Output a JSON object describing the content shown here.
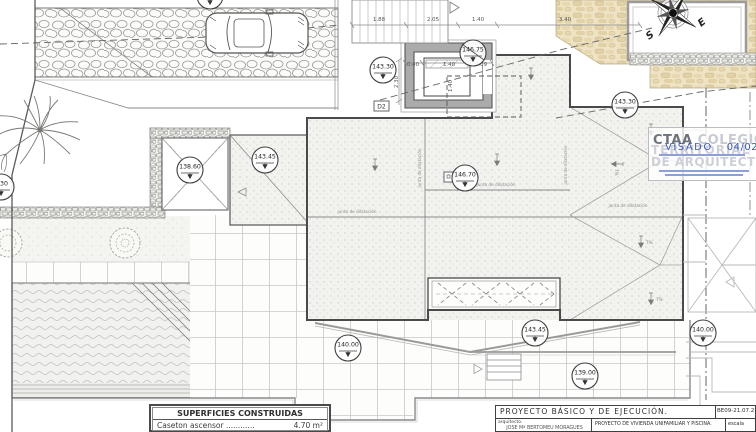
{
  "plan": {
    "markers": [
      {
        "value": "143.30",
        "x": 210,
        "y": -4
      },
      {
        "value": "143.30",
        "x": 383,
        "y": 70
      },
      {
        "value": "146.75",
        "x": 473,
        "y": 53,
        "strike": true
      },
      {
        "value": "143.30",
        "x": 625,
        "y": 105
      },
      {
        "value": "3.30",
        "x": 1,
        "y": 187
      },
      {
        "value": "138.60",
        "x": 190,
        "y": 170
      },
      {
        "value": "143.45",
        "x": 265,
        "y": 160
      },
      {
        "value": "146.70",
        "x": 465,
        "y": 178
      },
      {
        "value": "140.00",
        "x": 348,
        "y": 348
      },
      {
        "value": "143.45",
        "x": 535,
        "y": 333
      },
      {
        "value": "139.00",
        "x": 585,
        "y": 376
      },
      {
        "value": "140.00",
        "x": 703,
        "y": 333
      }
    ],
    "dimensions": [
      {
        "value": "1.88",
        "x": 379,
        "y": 21,
        "rot": 0
      },
      {
        "value": "2.05",
        "x": 433,
        "y": 21,
        "rot": 0
      },
      {
        "value": "1.40",
        "x": 478,
        "y": 21,
        "rot": 0
      },
      {
        "value": "3.40",
        "x": 565,
        "y": 21,
        "rot": 0
      },
      {
        "value": "0.40",
        "x": 413,
        "y": 66,
        "rot": 0
      },
      {
        "value": "1.40",
        "x": 449,
        "y": 66,
        "rot": 0
      },
      {
        "value": "0.09",
        "x": 481,
        "y": 66,
        "rot": 0
      },
      {
        "value": "2.30",
        "x": 398,
        "y": 82,
        "rot": -90
      },
      {
        "value": "1.40",
        "x": 452,
        "y": 86,
        "rot": -90
      }
    ],
    "slope_arrows": [
      {
        "x": 375,
        "y": 165,
        "rot": 0,
        "label": ""
      },
      {
        "x": 497,
        "y": 160,
        "rot": 0,
        "label": ""
      },
      {
        "x": 531,
        "y": 74,
        "rot": 0,
        "label": ""
      },
      {
        "x": 651,
        "y": 130,
        "rot": 0,
        "label": "7%"
      },
      {
        "x": 617,
        "y": 164,
        "rot": 90,
        "label": "7%"
      },
      {
        "x": 641,
        "y": 242,
        "rot": 0,
        "label": "7%"
      },
      {
        "x": 651,
        "y": 299,
        "rot": 0,
        "label": "7%"
      }
    ],
    "junta_labels": [
      {
        "text": "junta de dilatación",
        "x": 357,
        "y": 213,
        "rot": 0
      },
      {
        "text": "junta de dilatación",
        "x": 628,
        "y": 207,
        "rot": 0
      },
      {
        "text": "junta de dilatación",
        "x": 496,
        "y": 186,
        "rot": 0
      },
      {
        "text": "junta de dilatación",
        "x": 567,
        "y": 165,
        "rot": -90
      },
      {
        "text": "junta de dilatación",
        "x": 421,
        "y": 168,
        "rot": -90
      }
    ],
    "detail_labels": [
      {
        "label": "D2",
        "x": 374,
        "y": 101
      },
      {
        "label": "",
        "x": 444,
        "y": 172
      }
    ],
    "compass": {
      "label_s": "S",
      "label_e": "E"
    }
  },
  "stamp": {
    "org_bold": "CTAA",
    "org_light_1": "COLEGIO",
    "org_light_2": "TERRITORIAL",
    "org_light_3": "DE ARQUITECTOS",
    "visado_label": "VISADO",
    "visado_date": "04/02/22"
  },
  "superficies": {
    "title": "SUPERFICIES CONSTRUIDAS",
    "rows": [
      {
        "label": "Caseton ascensor ............",
        "value": "4.70 m²"
      }
    ]
  },
  "title_block": {
    "project": "PROYECTO BÁSICO Y DE EJECUCIÓN.",
    "code": "BE09-21.07.21",
    "architect_label": "arquitecto.",
    "architect_name": "JOSE Mª BERTOMEU MORAGUES",
    "description": "PROYECTO DE VIVIENDA UNIFAMILIAR Y PISCINA.",
    "scale_label": "escala"
  },
  "colors": {
    "stamp_blue": "#3d56c4",
    "stamp_gray": "#cdd1d7",
    "line_dark": "#4a4a4a",
    "beige": "#eee3c4"
  }
}
